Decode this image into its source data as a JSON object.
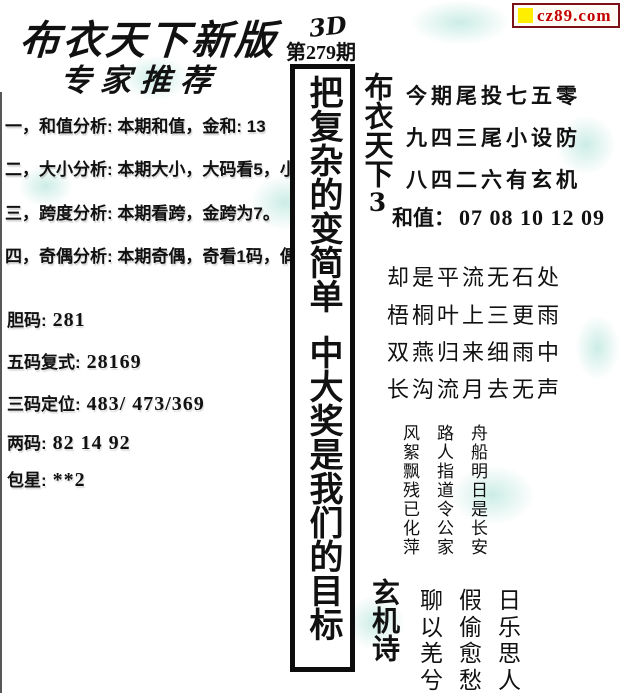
{
  "logo": {
    "text": "cz89.com"
  },
  "header": {
    "title": "布衣天下新版",
    "subtitle": "专家推荐"
  },
  "analysis": {
    "line1": "一，和值分析: 本期和值，金和: 13",
    "line2": "二，大小分析: 本期大小，大码看5，小码看0",
    "line3": "三，跨度分析: 本期看跨，金跨为7。",
    "line4": "四，奇偶分析: 本期奇偶，奇看1码，偶看6码。"
  },
  "picks": {
    "danma": {
      "label": "胆码:",
      "value": "281"
    },
    "wuma": {
      "label": "五码复式:",
      "value": "28169"
    },
    "sanma": {
      "label": "三码定位:",
      "value": "483/ 473/369"
    },
    "liangma": {
      "label": "两码:",
      "value": "82 14 92"
    },
    "baoxing": {
      "label": "包星:",
      "value": "**2"
    }
  },
  "center": {
    "game": "3D",
    "issue": "第279期",
    "slogan_part1": "把复杂的变简单",
    "slogan_part2": "中大奖是我们的目标"
  },
  "right_top": {
    "vertical_title": "布衣天下",
    "vertical_title_digit": "3",
    "line1": "今期尾投七五零",
    "line2": "九四三尾小设防",
    "line3": "八四二六有玄机",
    "hezhi_label": "和值：",
    "hezhi_value": "07 08 10 12 09"
  },
  "poem": {
    "line1": "却是平流无石处",
    "line2": "梧桐叶上三更雨",
    "line3": "双燕归来细雨中",
    "line4": "长沟流月去无声"
  },
  "vertical_poem": {
    "col1": "风絮飘残已化萍",
    "col2": "路人指道令公家",
    "col3": "舟船明日是长安"
  },
  "mystery": {
    "title": "玄机诗",
    "row1": "聊假日",
    "row2": "以偷乐",
    "row3": "羌愈思",
    "row4": "兮愁人"
  },
  "colors": {
    "logo_red": "#c40000",
    "logo_yellow": "#ffee00",
    "watermark": "#8ed6c6"
  }
}
